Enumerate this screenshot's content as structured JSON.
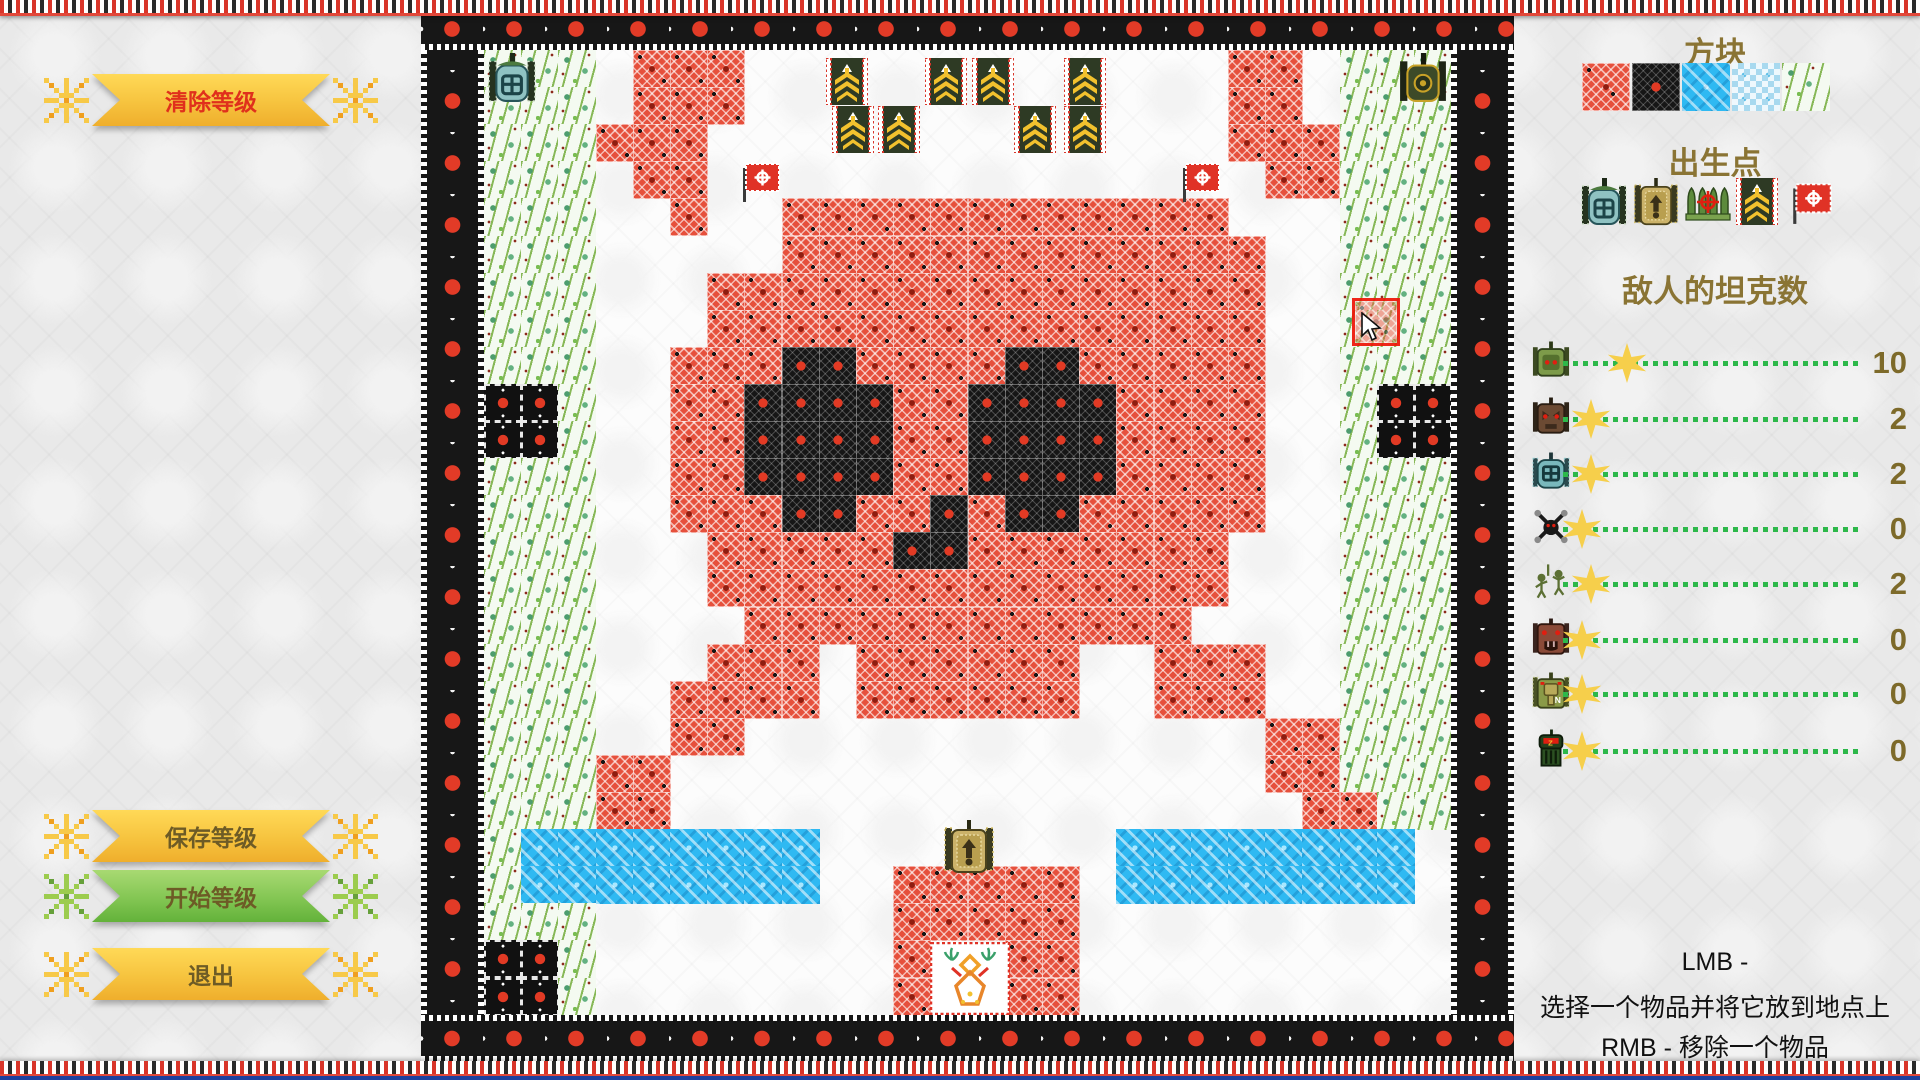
{
  "left_panel": {
    "buttons": [
      {
        "id": "clear",
        "label": "清除等级",
        "style": "yellow",
        "text_color": "#e0301c",
        "y": 74
      },
      {
        "id": "save",
        "label": "保存等级",
        "style": "yellow",
        "text_color": "#6d5b26",
        "y": 810
      },
      {
        "id": "start",
        "label": "开始等级",
        "style": "green",
        "text_color": "#6d5b26",
        "y": 870
      },
      {
        "id": "exit",
        "label": "退出",
        "style": "yellow",
        "text_color": "#6d5b26",
        "y": 948
      }
    ]
  },
  "right_panel": {
    "blocks_title": "方块",
    "block_tiles": [
      "brick",
      "steel",
      "water",
      "ice",
      "trees"
    ],
    "spawn_title": "出生点",
    "spawn_items": [
      "player-tank",
      "gold-tank",
      "shells",
      "banner",
      "flag"
    ],
    "enemy_title": "敌人的坦克数",
    "enemy_rows": [
      {
        "icon": "tank-green",
        "value": 10
      },
      {
        "icon": "tank-wolf",
        "value": 2
      },
      {
        "icon": "tank-teal",
        "value": 2
      },
      {
        "icon": "spider",
        "value": 0
      },
      {
        "icon": "soldiers",
        "value": 2
      },
      {
        "icon": "tank-bear",
        "value": 0
      },
      {
        "icon": "tank-n",
        "value": 0
      },
      {
        "icon": "tank-heavy",
        "value": 0
      }
    ],
    "instructions": [
      "LMB -",
      "选择一个物品并将它放到地点上",
      "RMB - 移除一个物品"
    ]
  },
  "map": {
    "grid": [
      "TTT.BBB.............BB.TTT",
      "TTT.BBB.............BB.TTT",
      "TTTBBB..............BBBTTT",
      "TTT.BB...............BBTTT",
      "TTT..B..BBBBBBBBBBBB...TTT",
      "TTT.....BBBBBBBBBBBBB..TTT",
      "TTT...BBBBBBBBBBBBBBB..TTT",
      "TTT...BBBBBBBBBBBBBBB..TTT",
      "TTT..BBBDDBBBBDDBBBBB..TTT",
      "SST..BBDDDDBBDDDDBBBB..TSS",
      "SST..BBDDDDBBDDDDBBBB..TSS",
      "TTT..BBDDDDBBDDDDBBBB..TTT",
      "TTT..BBBDDBBDBDDBBBBB..TTT",
      "TTT...BBBBBDDBBBBBBB...TTT",
      "TTT...BBBBBBBBBBBBBB...TTT",
      "TTT....BBBBBBBBBBBB....TTT",
      "TTT...BBB.BBBBBB..BBB..TTT",
      "TTT..BBBB.BBBBBB..BBB..TTT",
      "TTT..BB..............BBTTT",
      "TTTBB................BBTTT",
      "TTTBB.................BBTT",
      "TWWWWWWWW........WWWWWWWW.",
      "TWWWWWWWW..BBBBB.WWWWWWWW.",
      "TTT........BBBBB..........",
      "SST........B..BB..........",
      "SST........B..BB.........."
    ],
    "sprites": [
      {
        "type": "tank-player",
        "x": 487,
        "y": 53,
        "w": 50,
        "h": 50
      },
      {
        "type": "tank-dark",
        "x": 1398,
        "y": 53,
        "w": 50,
        "h": 50
      },
      {
        "type": "banner",
        "x": 826,
        "y": 58,
        "w": 42,
        "h": 47
      },
      {
        "type": "banner",
        "x": 925,
        "y": 58,
        "w": 42,
        "h": 47
      },
      {
        "type": "banner",
        "x": 972,
        "y": 58,
        "w": 42,
        "h": 47
      },
      {
        "type": "banner",
        "x": 1064,
        "y": 58,
        "w": 42,
        "h": 47
      },
      {
        "type": "banner",
        "x": 832,
        "y": 106,
        "w": 42,
        "h": 47
      },
      {
        "type": "banner",
        "x": 878,
        "y": 106,
        "w": 42,
        "h": 47
      },
      {
        "type": "banner",
        "x": 1014,
        "y": 106,
        "w": 42,
        "h": 47
      },
      {
        "type": "banner",
        "x": 1064,
        "y": 106,
        "w": 42,
        "h": 47
      },
      {
        "type": "flag",
        "x": 738,
        "y": 158,
        "w": 46,
        "h": 46
      },
      {
        "type": "flag",
        "x": 1178,
        "y": 158,
        "w": 46,
        "h": 46
      },
      {
        "type": "tank-gold",
        "x": 942,
        "y": 820,
        "w": 54,
        "h": 54
      },
      {
        "type": "base",
        "x": 930,
        "y": 942,
        "w": 80,
        "h": 73
      }
    ],
    "cursor": {
      "x": 1352,
      "y": 298,
      "size": 48,
      "hover_tile": "brick"
    }
  },
  "colors": {
    "button_yellow": "#f6c33e",
    "button_green": "#83c653",
    "title_olive": "#8a7434",
    "clear_text_red": "#e0301c",
    "brick_red": "#e6503c",
    "water_blue": "#2fb9f2",
    "slider_track_green": "#2db84a",
    "star_yellow": "#f6cf4b",
    "frame_black": "#171717",
    "frame_star_red": "#e23b27"
  }
}
